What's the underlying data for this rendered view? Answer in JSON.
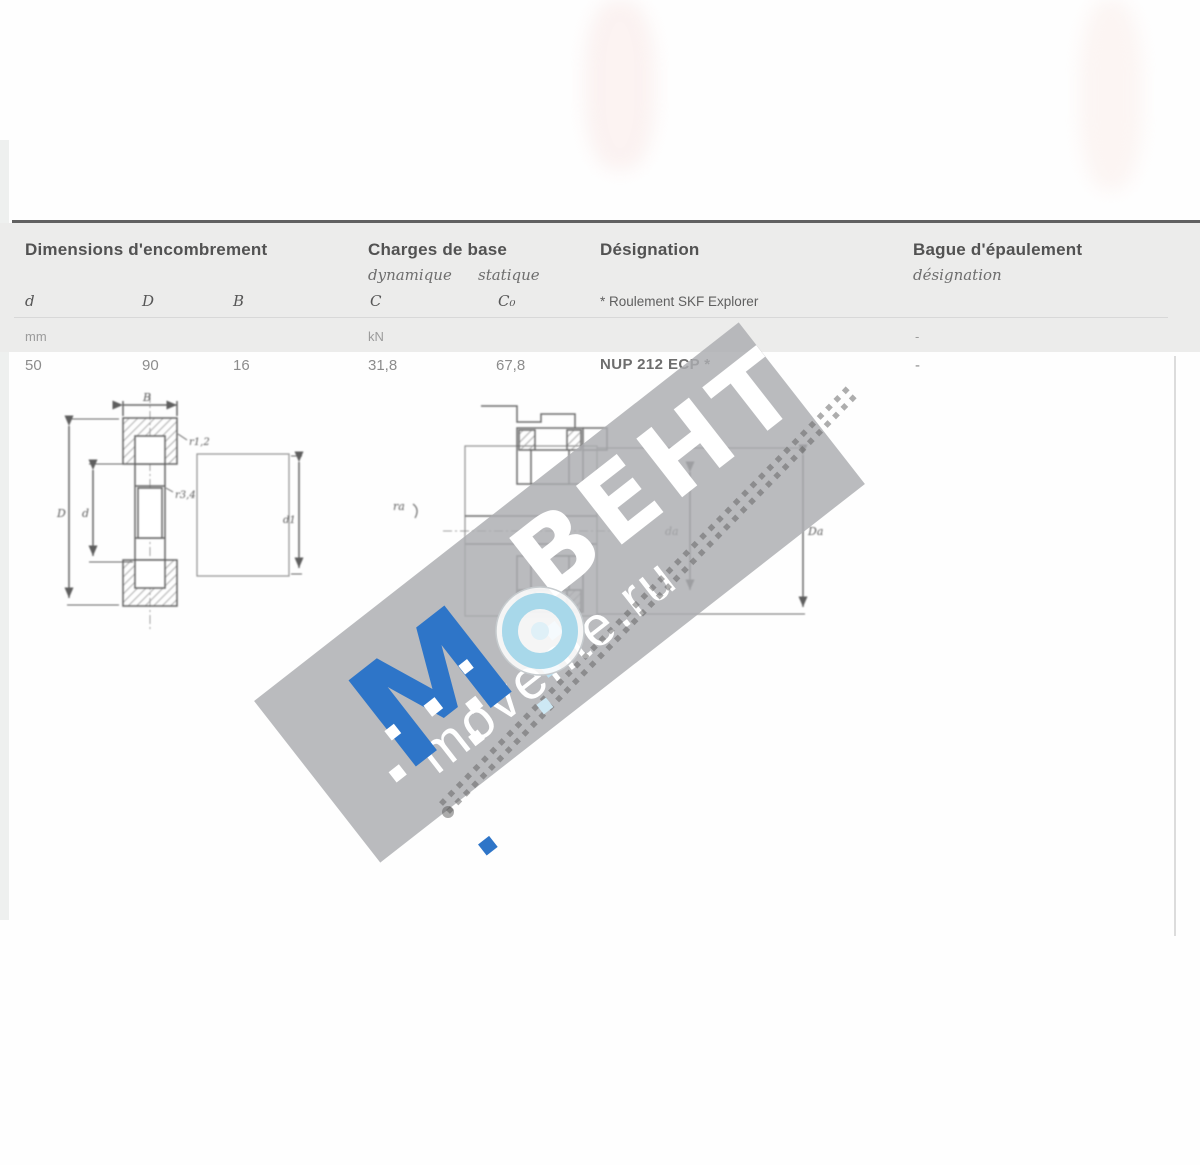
{
  "table": {
    "header": {
      "dimensions_title": "Dimensions d'encombrement",
      "loads_title": "Charges de base",
      "loads_sub_dynamic": "dynamique",
      "loads_sub_static": "statique",
      "designation_title": "Désignation",
      "designation_footnote": "* Roulement SKF Explorer",
      "abutment_title": "Bague d'épaulement",
      "abutment_subtitle": "désignation"
    },
    "symbols": {
      "d": "d",
      "D": "D",
      "B": "B",
      "C": "C",
      "C0": "C₀"
    },
    "units": {
      "dimensions": "mm",
      "loads": "kN",
      "abutment": "-"
    },
    "row": {
      "d": "50",
      "D": "90",
      "B": "16",
      "C": "31,8",
      "C0": "67,8",
      "designation": "NUP 212 ECP *",
      "abutment": "-"
    }
  },
  "drawing_left": {
    "label_B": "B",
    "label_r12": "r1,2",
    "label_r34": "r3,4",
    "label_d": "d",
    "label_D": "D",
    "label_d1": "d1"
  },
  "drawing_right": {
    "label_ra": "ra",
    "label_da": "da",
    "label_Da": "Da"
  },
  "watermark": {
    "brand": "ВЕНТ",
    "site": "movente.ru",
    "letter": "M"
  },
  "colors": {
    "accent_blue": "#2e75c8",
    "light_blue": "#a8d8ea",
    "band_gray": "#ababaf"
  }
}
